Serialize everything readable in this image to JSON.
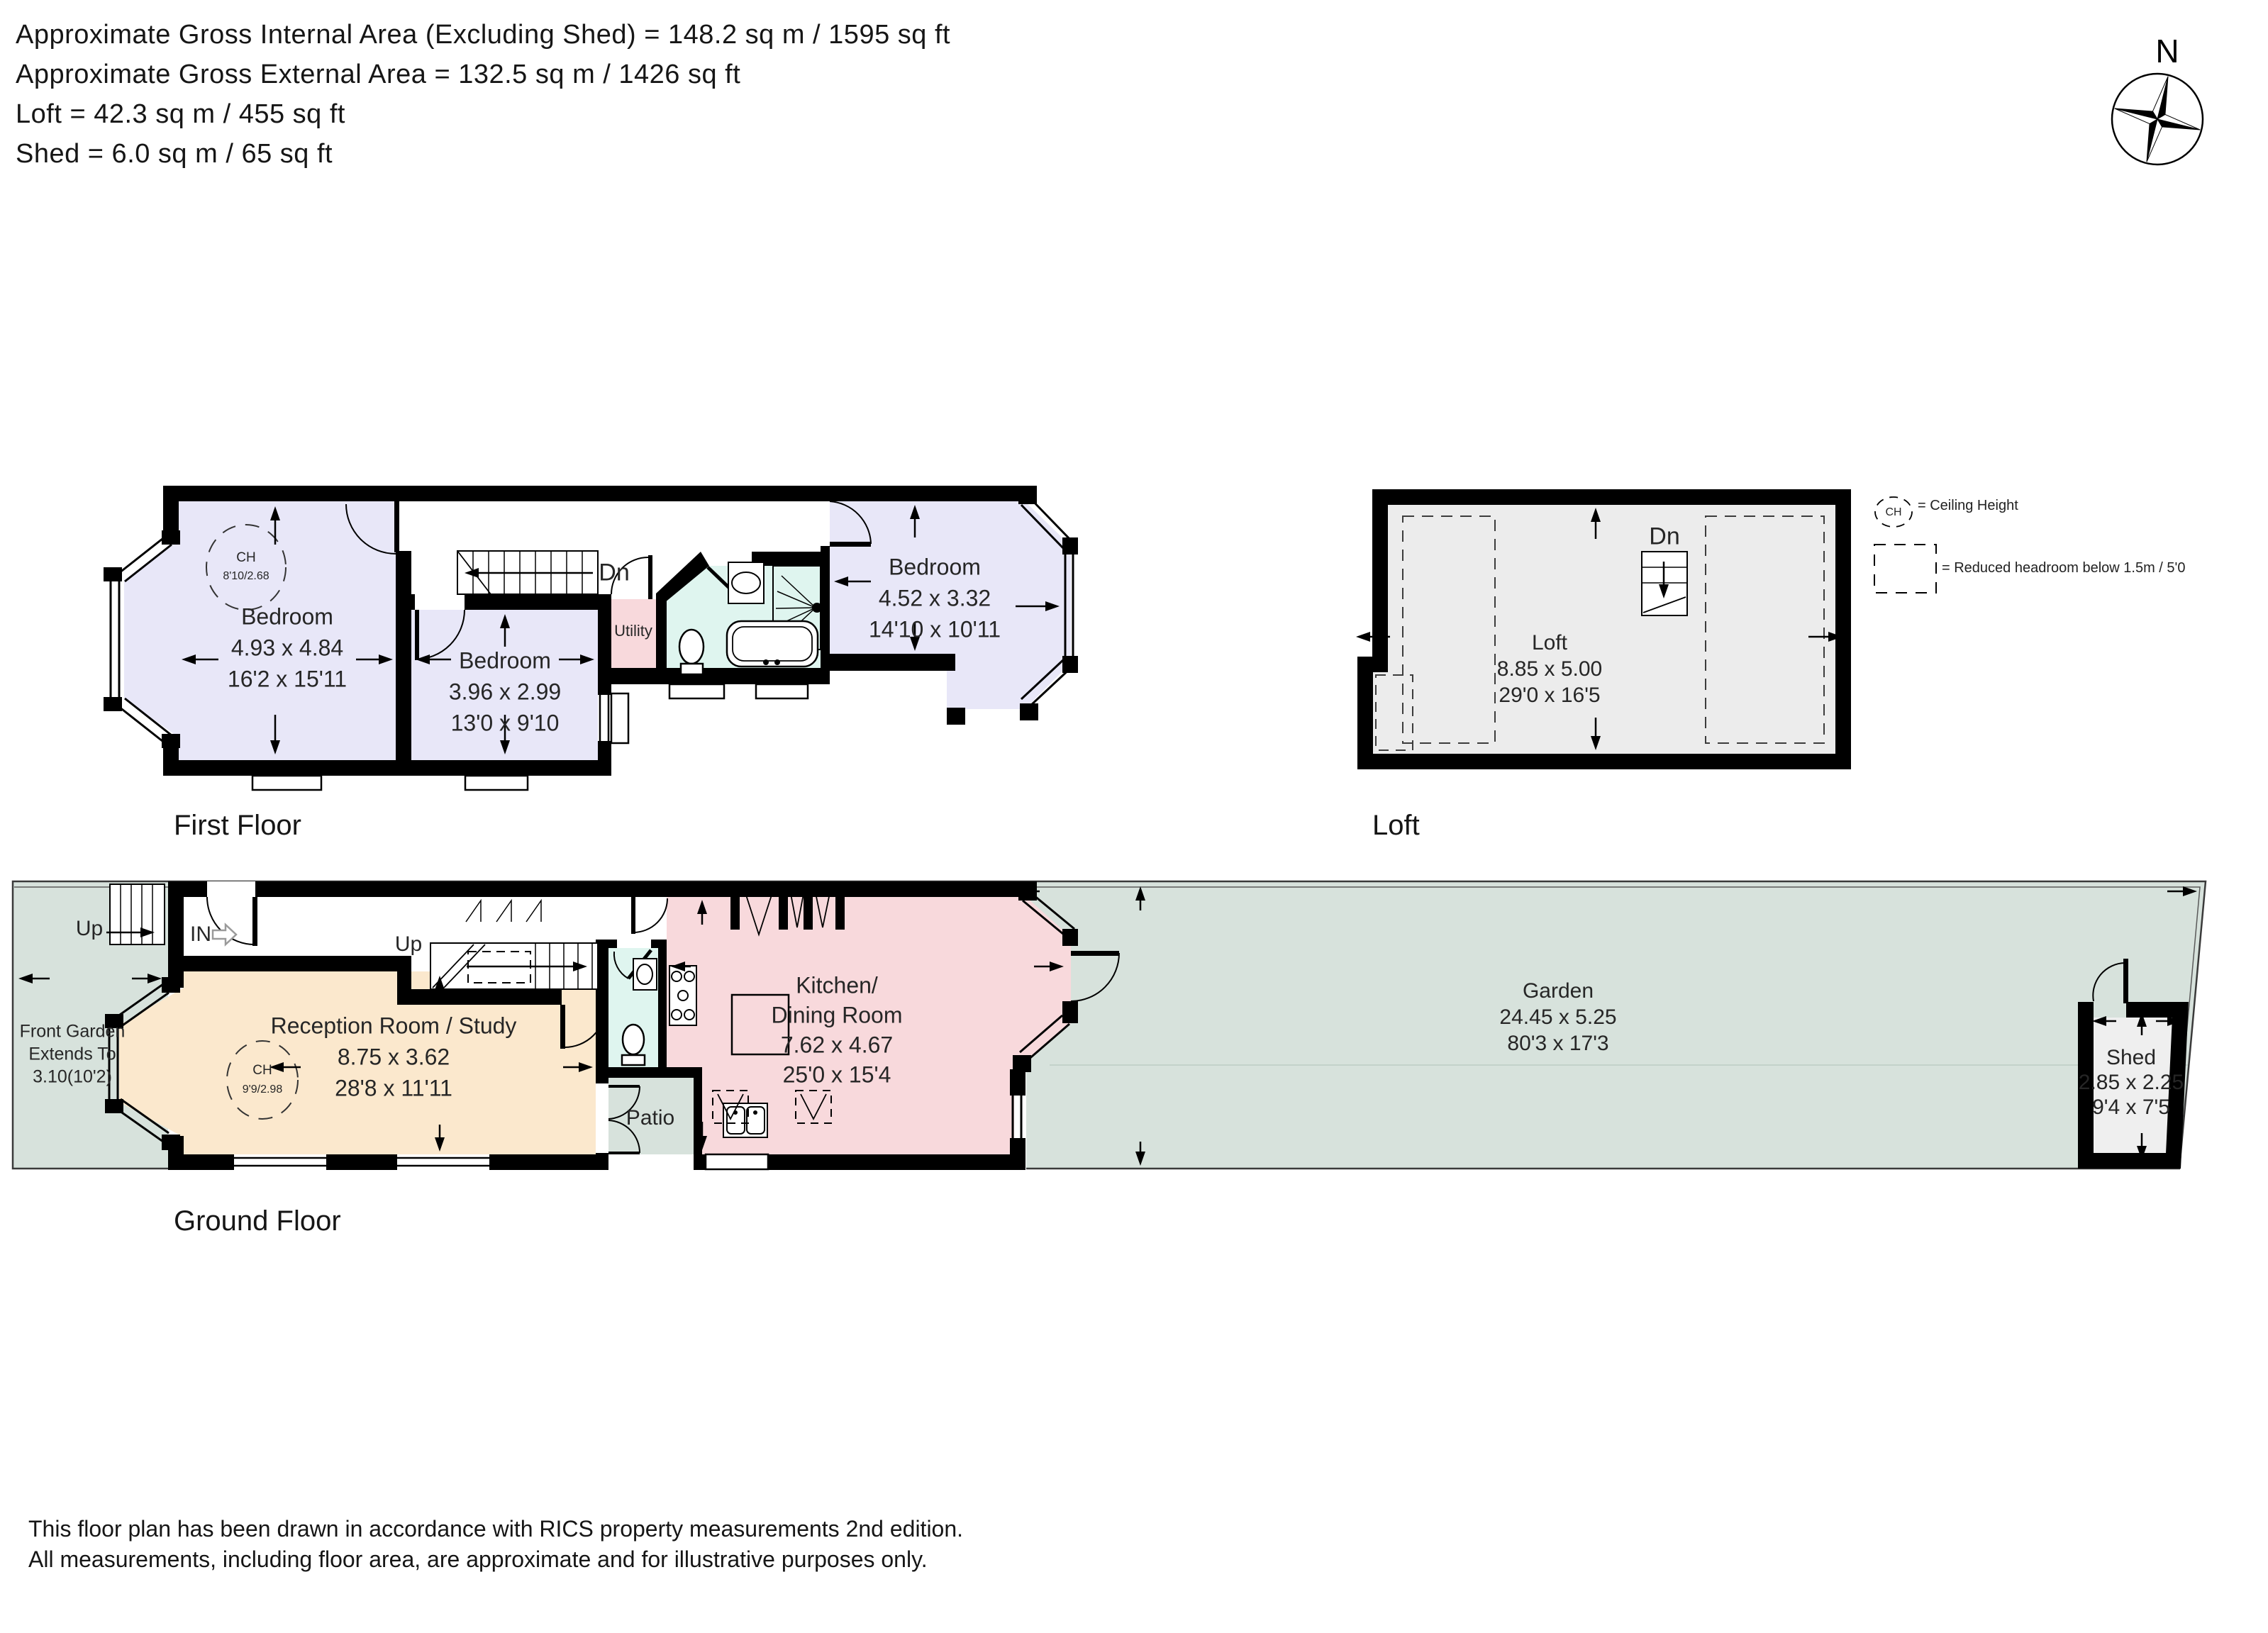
{
  "header": {
    "line1": "Approximate Gross Internal Area (Excluding Shed) = 148.2 sq m / 1595 sq ft",
    "line2": "Approximate Gross External Area = 132.5 sq m / 1426 sq ft",
    "line3": "Loft = 42.3 sq m / 455 sq ft",
    "line4": "Shed = 6.0 sq m / 65 sq ft"
  },
  "compass": {
    "north_label": "N"
  },
  "floors": {
    "first": {
      "caption": "First Floor",
      "bedroom1": {
        "name": "Bedroom",
        "metric": "4.93 x 4.84",
        "imperial": "16'2 x 15'11",
        "ch_label": "CH",
        "ch_value": "8'10/2.68"
      },
      "bedroom2": {
        "name": "Bedroom",
        "metric": "3.96 x 2.99",
        "imperial": "13'0 x 9'10"
      },
      "bedroom3": {
        "name": "Bedroom",
        "metric": "4.52 x 3.32",
        "imperial": "14'10 x 10'11"
      },
      "utility_label": "Utility",
      "stairs_down_label": "Dn"
    },
    "loft": {
      "caption": "Loft",
      "room": {
        "name": "Loft",
        "metric": "8.85 x 5.00",
        "imperial": "29'0 x 16'5"
      },
      "stairs_down_label": "Dn"
    },
    "ground": {
      "caption": "Ground Floor",
      "front_garden": {
        "line1": "Front Garden",
        "line2": "Extends To",
        "line3": "3.10(10'2)"
      },
      "entrance_label": "IN",
      "front_steps_label": "Up",
      "stairs_up_label": "Up",
      "reception": {
        "name": "Reception Room / Study",
        "metric": "8.75 x 3.62",
        "imperial": "28'8 x 11'11",
        "ch_label": "CH",
        "ch_value": "9'9/2.98"
      },
      "kitchen": {
        "name_line1": "Kitchen/",
        "name_line2": "Dining Room",
        "metric": "7.62 x 4.67",
        "imperial": "25'0 x 15'4"
      },
      "patio_label": "Patio",
      "garden": {
        "name": "Garden",
        "metric": "24.45 x 5.25",
        "imperial": "80'3 x 17'3"
      },
      "shed": {
        "name": "Shed",
        "metric": "2.85 x 2.25",
        "imperial": "9'4 x 7'5"
      }
    }
  },
  "legend": {
    "ch_symbol": "CH",
    "ch_text": "= Ceiling Height",
    "reduced_headroom_text": "= Reduced headroom below 1.5m / 5'0"
  },
  "footer": {
    "line1": "This floor plan has been drawn in accordance with RICS property measurements 2nd edition.",
    "line2": "All measurements, including floor area, are approximate and for illustrative purposes only."
  },
  "colors": {
    "wall": "#000000",
    "bedroom_fill": "#E8E7F8",
    "bathroom_fill": "#DFF5EF",
    "kitchen_fill": "#F8D9DC",
    "reception_fill": "#FBE8CD",
    "garden_fill": "#D7E2DC",
    "loft_fill": "#ECECEC",
    "shed_fill": "#EFEFEF"
  }
}
